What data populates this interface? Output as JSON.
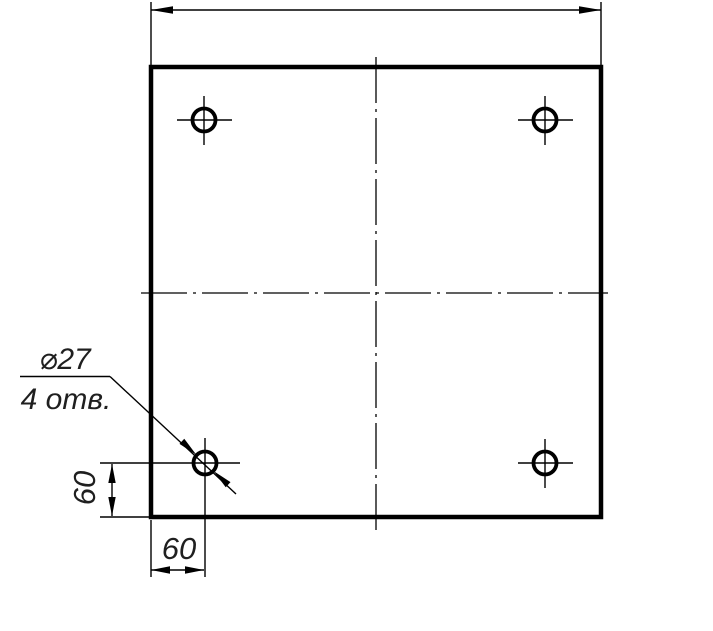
{
  "drawing": {
    "type": "engineering-drawing",
    "description": "Square plate, front view, four drilled holes with center marks",
    "colors": {
      "line": "#000000",
      "text": "#1f1f1f",
      "background": "#ffffff"
    },
    "plate": {
      "shape": "square",
      "holes_count": 4
    },
    "leader_note": {
      "line1": "⌀27",
      "line2": "4 отв."
    },
    "dimensions": {
      "top_overall": "",
      "left_vertical": "60",
      "bottom_horizontal": "60"
    }
  }
}
